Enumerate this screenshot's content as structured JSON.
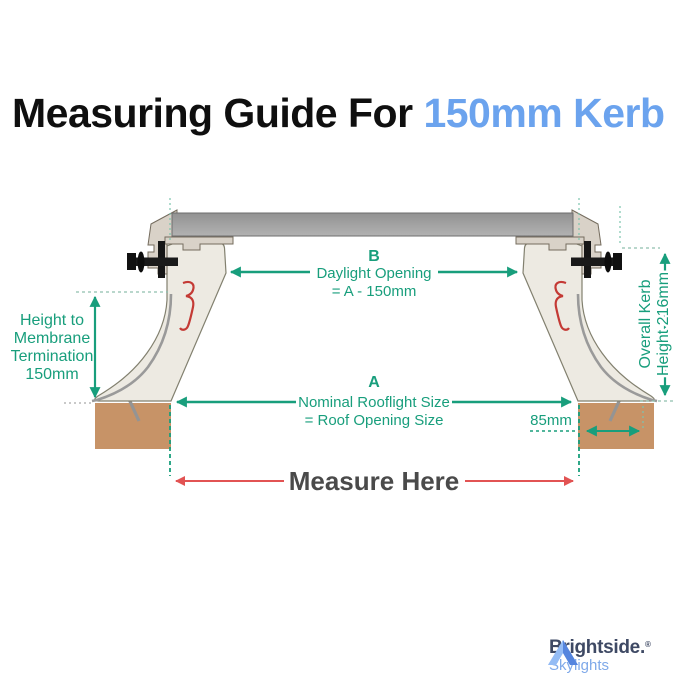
{
  "title": {
    "prefix": "Measuring Guide For ",
    "highlight": "150mm Kerb"
  },
  "diagram": {
    "dim_b": {
      "letter": "B",
      "line1": "Daylight Opening",
      "line2": "= A - 150mm"
    },
    "dim_a": {
      "letter": "A",
      "line1": "Nominal Rooflight Size",
      "line2": "= Roof Opening Size"
    },
    "dim_membrane": {
      "line1": "Height to",
      "line2": "Membrane",
      "line3": "Termination",
      "line4": "150mm"
    },
    "dim_kerb_height": {
      "line1": "Overall Kerb",
      "line2": "Height 216mm"
    },
    "dim_kerb_width": "85mm",
    "measure_here": "Measure Here"
  },
  "logo": {
    "brand": "Brightside.",
    "reg": "®",
    "tagline": "Skylights"
  },
  "colors": {
    "dimension_teal": "#189E7C",
    "measure_red": "#E25353",
    "title_accent_blue": "#6BA3EE",
    "timber_brown": "#C79367",
    "kerb_fill": "#EDEAE2",
    "clamp_fill": "#D9D2C8",
    "glass_gray": "#9E9E9E",
    "logo_navy": "#3E4964",
    "logo_light_blue": "#7FA9E9"
  }
}
